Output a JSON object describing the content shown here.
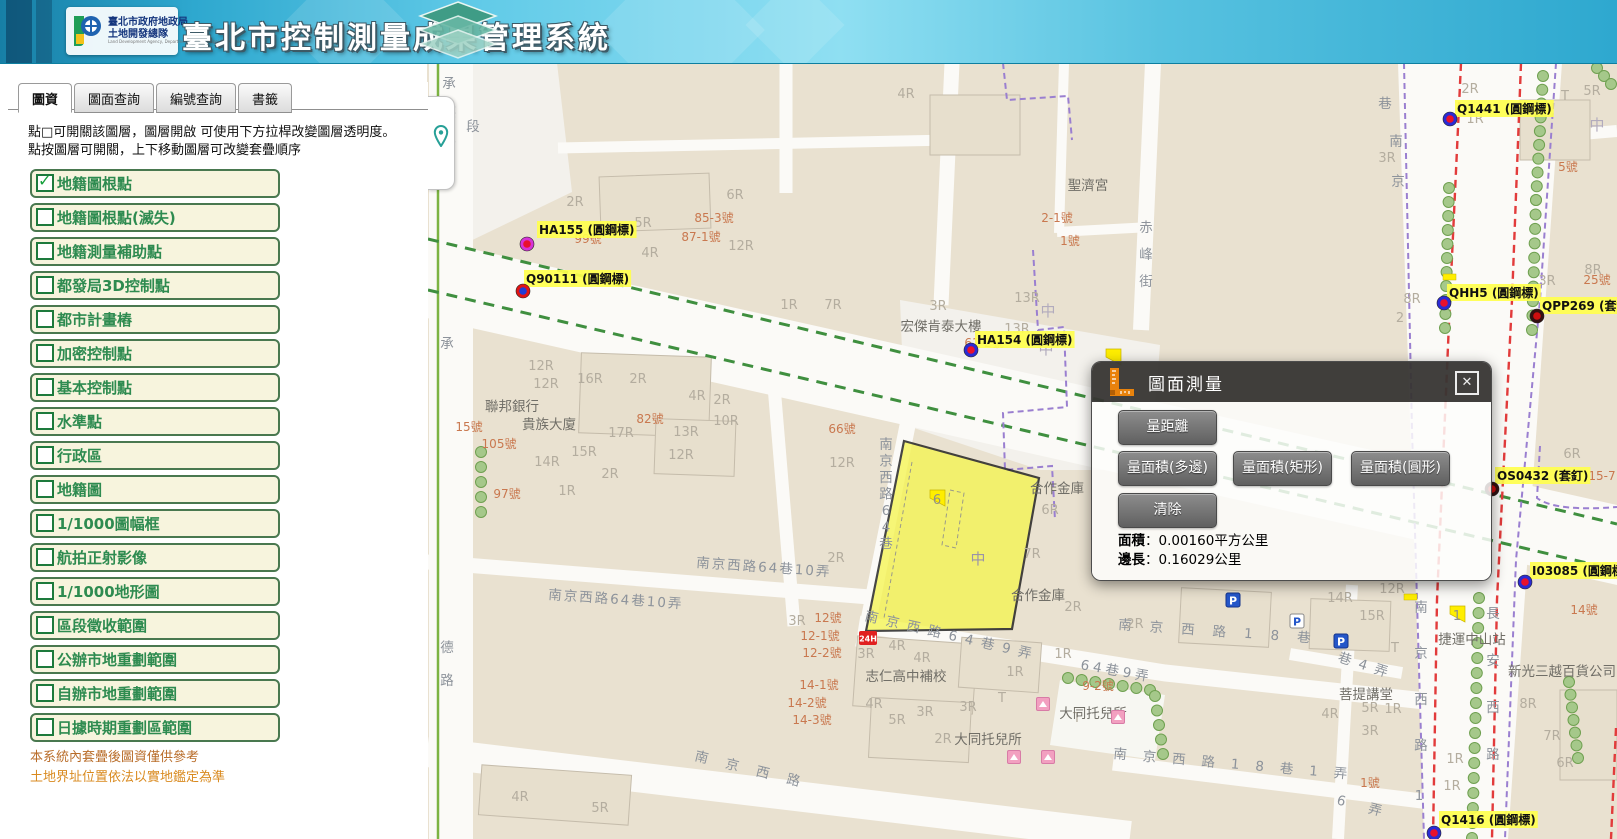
{
  "header": {
    "logo_line1": "臺北市政府地政局",
    "logo_line2": "土地開發總隊",
    "logo_sub": "Land Development Agency, Department of Land, Taipei City Government",
    "title": "臺北市控制測量成果管理系統"
  },
  "sidebar": {
    "tabs": [
      {
        "label": "圖資",
        "active": true
      },
      {
        "label": "圖面查詢",
        "active": false
      },
      {
        "label": "編號查詢",
        "active": false
      },
      {
        "label": "書籤",
        "active": false
      }
    ],
    "instructions": "點□可開關該圖層，圖層開啟 可使用下方拉桿改變圖層透明度。 點按圖層可開關，上下移動圖層可改變套疊順序",
    "layers": [
      {
        "label": "地籍圖根點",
        "checked": true
      },
      {
        "label": "地籍圖根點(滅失)",
        "checked": false
      },
      {
        "label": "地籍測量補助點",
        "checked": false
      },
      {
        "label": "都發局3D控制點",
        "checked": false
      },
      {
        "label": "都市計畫樁",
        "checked": false
      },
      {
        "label": "加密控制點",
        "checked": false
      },
      {
        "label": "基本控制點",
        "checked": false
      },
      {
        "label": "水準點",
        "checked": false
      },
      {
        "label": "行政區",
        "checked": false
      },
      {
        "label": "地籍圖",
        "checked": false
      },
      {
        "label": "1/1000圖幅框",
        "checked": false
      },
      {
        "label": "航拍正射影像",
        "checked": false
      },
      {
        "label": "1/1000地形圖",
        "checked": false
      },
      {
        "label": "區段徵收範圍",
        "checked": false
      },
      {
        "label": "公辦市地重劃範圍",
        "checked": false
      },
      {
        "label": "自辦市地重劃範圍",
        "checked": false
      },
      {
        "label": "日據時期重劃區範圍",
        "checked": false
      }
    ],
    "notes": [
      "本系統內套疊後圖資僅供參考",
      "土地界址位置依法以實地鑑定為準"
    ]
  },
  "measure_dialog": {
    "title": "圖面測量",
    "close_label": "✕",
    "buttons": {
      "distance": "量距離",
      "area_polygon": "量面積(多邊)",
      "area_rect": "量面積(矩形)",
      "area_circle": "量面積(圓形)",
      "clear": "清除"
    },
    "results": [
      {
        "label": "面積",
        "value": "0.00160平方公里"
      },
      {
        "label": "邊長",
        "value": "0.16029公里"
      }
    ]
  },
  "map": {
    "colors": {
      "block": "#e9e1d0",
      "street": "#fbfaf7",
      "parcel_fill": "#f5f552",
      "parcel_stroke": "#141414",
      "green_dash": "#3f8f3f",
      "purple_dash": "#9a7fd0",
      "red_dash": "#e23b3b",
      "label_street": "#8d939b",
      "label_bldg": "#b4ad9f",
      "label_number": "#c9784f",
      "label_place": "#706e67",
      "point_label_bg": "#ffff4d",
      "tree_fill": "#a5c88a",
      "tree_stroke": "#6fa050"
    },
    "parcel_label": "6",
    "point_markers": [
      {
        "label": "Q1441 (圓鋼標)",
        "x": 1450,
        "y": 119,
        "lx": 1457,
        "ly": 113,
        "fill": "#e8112d",
        "ring": "#2b2bd4"
      },
      {
        "label": "HA155 (圓鋼標)",
        "x": 527,
        "y": 244,
        "lx": 539,
        "ly": 234,
        "fill": "#e8112d",
        "ring": "#d633d6"
      },
      {
        "label": "Q90111 (圓鋼標)",
        "x": 523,
        "y": 291,
        "lx": 526,
        "ly": 283,
        "fill": "#1f3bd6",
        "ring": "#e01313"
      },
      {
        "label": "HA154 (圓鋼標)",
        "x": 971,
        "y": 350,
        "lx": 977,
        "ly": 344,
        "fill": "#e8112d",
        "ring": "#2b2bd4"
      },
      {
        "label": "QHH5 (圓鋼標)",
        "x": 1444,
        "y": 303,
        "lx": 1449,
        "ly": 297,
        "fill": "#e8112d",
        "ring": "#2b2bd4"
      },
      {
        "label": "QPP269 (套釘)",
        "x": 1537,
        "y": 316,
        "lx": 1542,
        "ly": 310,
        "fill": "#cc0f0f",
        "ring": "#331111"
      },
      {
        "label": "OS0432 (套釘)",
        "x": 1492,
        "y": 489,
        "lx": 1497,
        "ly": 480,
        "fill": "#cc0f0f",
        "ring": "#331111"
      },
      {
        "label": "I03085 (圓鋼標)",
        "x": 1525,
        "y": 582,
        "lx": 1532,
        "ly": 575,
        "fill": "#e8112d",
        "ring": "#2b2bd4"
      },
      {
        "label": "Q1416 (圓鋼標)",
        "x": 1434,
        "y": 833,
        "lx": 1441,
        "ly": 824,
        "fill": "#e8112d",
        "ring": "#2b2bd4"
      }
    ],
    "street_labels": [
      {
        "t": "承德路",
        "x": 449,
        "y": 88,
        "v": 1,
        "g": 29
      },
      {
        "t": "段",
        "x": 473,
        "y": 131
      },
      {
        "t": "承",
        "x": 447,
        "y": 348
      },
      {
        "t": "德路",
        "x": 447,
        "y": 652,
        "v": 1,
        "g": 33
      },
      {
        "t": "南京西路64巷",
        "x": 886,
        "y": 449,
        "v": 1,
        "g": 16.5
      },
      {
        "t": "南京西路64巷10弄",
        "x": 548,
        "y": 599,
        "r": 4,
        "ls": 2
      },
      {
        "t": "南京西路64巷10弄",
        "x": 696,
        "y": 567,
        "r": 4,
        "ls": 2
      },
      {
        "t": "南京西路64巷9弄",
        "x": 864,
        "y": 620,
        "r": 13,
        "ls": 8
      },
      {
        "t": "64巷9弄",
        "x": 1080,
        "y": 669,
        "r": 10,
        "ls": 4
      },
      {
        "t": "南京西路18巷",
        "x": 1118,
        "y": 629,
        "r": 4,
        "ls": 18
      },
      {
        "t": "南京西路18巷1弄",
        "x": 1113,
        "y": 758,
        "r": 5,
        "ls": 16
      },
      {
        "t": "南京西路",
        "x": 694,
        "y": 760,
        "r": 14,
        "ls": 18
      },
      {
        "t": "巷4弄",
        "x": 1337,
        "y": 661,
        "r": 18,
        "ls": 8
      },
      {
        "t": "6弄",
        "x": 1336,
        "y": 804,
        "r": 15,
        "ls": 24
      },
      {
        "t": "南京西路",
        "x": 1421,
        "y": 612,
        "v": 1,
        "g": 46
      },
      {
        "t": "1",
        "x": 1419,
        "y": 800
      },
      {
        "t": "長安西路",
        "x": 1493,
        "y": 618,
        "v": 1,
        "g": 47
      },
      {
        "t": "赤峰街",
        "x": 1146,
        "y": 232,
        "v": 1,
        "g": 27
      },
      {
        "t": "巷",
        "x": 1385,
        "y": 108
      },
      {
        "t": "南",
        "x": 1396,
        "y": 146
      },
      {
        "t": "京",
        "x": 1398,
        "y": 186
      },
      {
        "t": "中",
        "x": 1048,
        "y": 316,
        "s": 15,
        "c": "#b2abbd"
      },
      {
        "t": "中",
        "x": 1046,
        "y": 354,
        "s": 15,
        "c": "#b2abbd"
      },
      {
        "t": "中",
        "x": 978,
        "y": 564,
        "s": 15,
        "c": "#9a94a8"
      },
      {
        "t": "中",
        "x": 1597,
        "y": 130,
        "s": 15,
        "c": "#b2abbd"
      }
    ],
    "place_labels": [
      {
        "t": "聯邦銀行",
        "x": 512,
        "y": 411
      },
      {
        "t": "貴族大廈",
        "x": 549,
        "y": 429
      },
      {
        "t": "宏傑肯泰大樓",
        "x": 941,
        "y": 331
      },
      {
        "t": "聖濟宮",
        "x": 1088,
        "y": 190
      },
      {
        "t": "合作金庫",
        "x": 1057,
        "y": 493
      },
      {
        "t": "合作金庫",
        "x": 1038,
        "y": 600
      },
      {
        "t": "志仁高中補校",
        "x": 906,
        "y": 681
      },
      {
        "t": "大同托兒所",
        "x": 988,
        "y": 744
      },
      {
        "t": "大同托兒所",
        "x": 1093,
        "y": 718
      },
      {
        "t": "捷運中山站",
        "x": 1472,
        "y": 644
      },
      {
        "t": "新光三越百貨公司",
        "x": 1562,
        "y": 676
      },
      {
        "t": "菩提講堂",
        "x": 1366,
        "y": 699
      }
    ],
    "number_labels": [
      {
        "t": "99號",
        "x": 588,
        "y": 243
      },
      {
        "t": "85-3號",
        "x": 714,
        "y": 222
      },
      {
        "t": "87-1號",
        "x": 701,
        "y": 241
      },
      {
        "t": "61-2號",
        "x": 984,
        "y": 347
      },
      {
        "t": "105號",
        "x": 499,
        "y": 448
      },
      {
        "t": "97號",
        "x": 507,
        "y": 498
      },
      {
        "t": "15號",
        "x": 469,
        "y": 431
      },
      {
        "t": "82號",
        "x": 650,
        "y": 423
      },
      {
        "t": "66號",
        "x": 842,
        "y": 433
      },
      {
        "t": "2-1號",
        "x": 1057,
        "y": 222
      },
      {
        "t": "1號",
        "x": 1070,
        "y": 245
      },
      {
        "t": "12號",
        "x": 828,
        "y": 622
      },
      {
        "t": "12-1號",
        "x": 820,
        "y": 640
      },
      {
        "t": "12-2號",
        "x": 822,
        "y": 657
      },
      {
        "t": "14-1號",
        "x": 819,
        "y": 689
      },
      {
        "t": "14-2號",
        "x": 807,
        "y": 707
      },
      {
        "t": "14-3號",
        "x": 812,
        "y": 724
      },
      {
        "t": "9-2號",
        "x": 1098,
        "y": 690
      },
      {
        "t": "25號",
        "x": 1597,
        "y": 284
      },
      {
        "t": "5號",
        "x": 1568,
        "y": 171
      },
      {
        "t": "1號",
        "x": 1370,
        "y": 787
      },
      {
        "t": "14號",
        "x": 1584,
        "y": 614
      },
      {
        "t": "15-7",
        "x": 1602,
        "y": 480
      }
    ],
    "building_labels": [
      {
        "t": "12R",
        "x": 541,
        "y": 370
      },
      {
        "t": "12R",
        "x": 546,
        "y": 388
      },
      {
        "t": "16R",
        "x": 590,
        "y": 383
      },
      {
        "t": "2R",
        "x": 638,
        "y": 383
      },
      {
        "t": "4R",
        "x": 697,
        "y": 400
      },
      {
        "t": "2R",
        "x": 722,
        "y": 404
      },
      {
        "t": "10R",
        "x": 726,
        "y": 425
      },
      {
        "t": "17R",
        "x": 621,
        "y": 437
      },
      {
        "t": "13R",
        "x": 686,
        "y": 436
      },
      {
        "t": "15R",
        "x": 584,
        "y": 456
      },
      {
        "t": "14R",
        "x": 547,
        "y": 466
      },
      {
        "t": "12R",
        "x": 681,
        "y": 459
      },
      {
        "t": "2R",
        "x": 610,
        "y": 478
      },
      {
        "t": "1R",
        "x": 567,
        "y": 495
      },
      {
        "t": "2R",
        "x": 575,
        "y": 206
      },
      {
        "t": "5R",
        "x": 643,
        "y": 227
      },
      {
        "t": "4R",
        "x": 650,
        "y": 257
      },
      {
        "t": "6R",
        "x": 735,
        "y": 199
      },
      {
        "t": "12R",
        "x": 741,
        "y": 250
      },
      {
        "t": "4R",
        "x": 906,
        "y": 98
      },
      {
        "t": "3R",
        "x": 938,
        "y": 310
      },
      {
        "t": "13R",
        "x": 1027,
        "y": 302
      },
      {
        "t": "13R",
        "x": 1017,
        "y": 333
      },
      {
        "t": "1R",
        "x": 789,
        "y": 309
      },
      {
        "t": "7R",
        "x": 833,
        "y": 309
      },
      {
        "t": "12R",
        "x": 842,
        "y": 467
      },
      {
        "t": "2R",
        "x": 836,
        "y": 562
      },
      {
        "t": "6R",
        "x": 1050,
        "y": 514
      },
      {
        "t": "7R",
        "x": 1032,
        "y": 558
      },
      {
        "t": "2R",
        "x": 1073,
        "y": 611
      },
      {
        "t": "2R",
        "x": 1135,
        "y": 628
      },
      {
        "t": "3R",
        "x": 797,
        "y": 625
      },
      {
        "t": "3R",
        "x": 866,
        "y": 658
      },
      {
        "t": "4R",
        "x": 897,
        "y": 650
      },
      {
        "t": "4R",
        "x": 922,
        "y": 662
      },
      {
        "t": "1R",
        "x": 1015,
        "y": 676
      },
      {
        "t": "1R",
        "x": 1063,
        "y": 658
      },
      {
        "t": "4R",
        "x": 874,
        "y": 708
      },
      {
        "t": "5R",
        "x": 897,
        "y": 724
      },
      {
        "t": "3R",
        "x": 925,
        "y": 716
      },
      {
        "t": "3R",
        "x": 968,
        "y": 711
      },
      {
        "t": "2R",
        "x": 943,
        "y": 743
      },
      {
        "t": "4R",
        "x": 520,
        "y": 801
      },
      {
        "t": "5R",
        "x": 600,
        "y": 812
      },
      {
        "t": "14R",
        "x": 1340,
        "y": 602
      },
      {
        "t": "12R",
        "x": 1392,
        "y": 593
      },
      {
        "t": "15R",
        "x": 1372,
        "y": 620
      },
      {
        "t": "5R",
        "x": 1370,
        "y": 712
      },
      {
        "t": "1R",
        "x": 1393,
        "y": 713
      },
      {
        "t": "4R",
        "x": 1330,
        "y": 718
      },
      {
        "t": "3R",
        "x": 1370,
        "y": 735
      },
      {
        "t": "1R",
        "x": 1455,
        "y": 763
      },
      {
        "t": "1R",
        "x": 1452,
        "y": 790
      },
      {
        "t": "8R",
        "x": 1528,
        "y": 708
      },
      {
        "t": "7R",
        "x": 1552,
        "y": 740
      },
      {
        "t": "6R",
        "x": 1565,
        "y": 767
      },
      {
        "t": "2R",
        "x": 1470,
        "y": 93
      },
      {
        "t": "1R",
        "x": 1475,
        "y": 123
      },
      {
        "t": "5R",
        "x": 1592,
        "y": 95
      },
      {
        "t": "3R",
        "x": 1387,
        "y": 162
      },
      {
        "t": "8R",
        "x": 1593,
        "y": 274
      },
      {
        "t": "8R",
        "x": 1412,
        "y": 303
      },
      {
        "t": "3R",
        "x": 1547,
        "y": 285
      },
      {
        "t": "6R",
        "x": 1572,
        "y": 458
      },
      {
        "t": "T",
        "x": 1395,
        "y": 652
      },
      {
        "t": "T",
        "x": 1002,
        "y": 702
      },
      {
        "t": "T",
        "x": 1077,
        "y": 722
      },
      {
        "t": "T",
        "x": 1565,
        "y": 100
      },
      {
        "t": "2",
        "x": 1400,
        "y": 322
      }
    ],
    "icons": [
      {
        "t": "p_blue",
        "x": 1233,
        "y": 600
      },
      {
        "t": "p_light",
        "x": 1297,
        "y": 621
      },
      {
        "t": "p_blue",
        "x": 1341,
        "y": 641
      },
      {
        "t": "badge24",
        "x": 868,
        "y": 638,
        "text": "24H"
      },
      {
        "t": "pink",
        "x": 1043,
        "y": 704
      },
      {
        "t": "pink",
        "x": 1118,
        "y": 717
      },
      {
        "t": "pink",
        "x": 1014,
        "y": 757
      },
      {
        "t": "pink",
        "x": 1048,
        "y": 757
      },
      {
        "t": "flag",
        "n": "6",
        "x": 930,
        "y": 490
      },
      {
        "t": "flag",
        "n": "1",
        "x": 1450,
        "y": 606
      },
      {
        "t": "flagbar",
        "x": 1410,
        "y": 597
      },
      {
        "t": "flagbar",
        "x": 1449,
        "y": 277
      },
      {
        "t": "flag",
        "n": "",
        "x": 1106,
        "y": 349
      }
    ]
  }
}
